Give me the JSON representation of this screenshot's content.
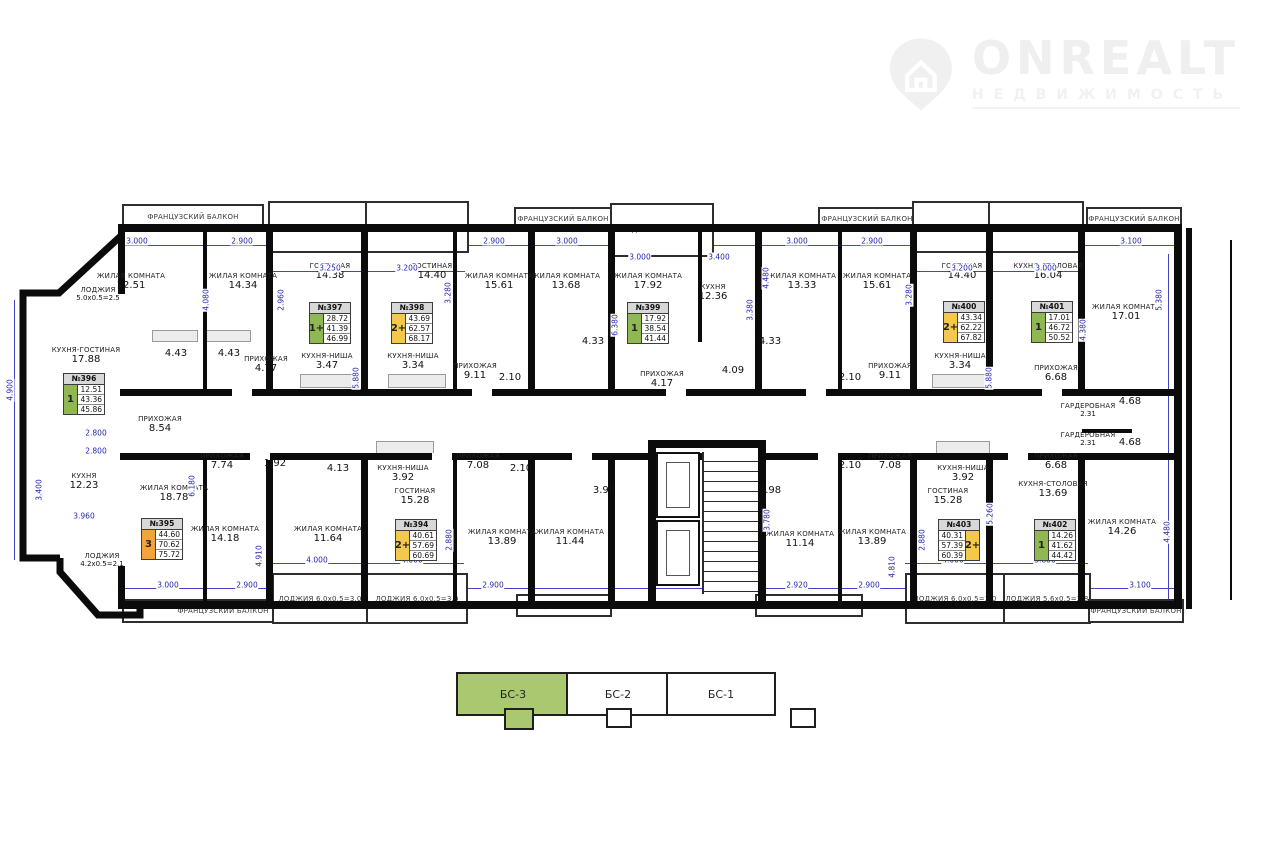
{
  "logo": {
    "brand": "ONREALT",
    "subtitle": "НЕДВИЖИМОСТЬ"
  },
  "colors": {
    "g": "#8fb852",
    "y": "#f3c84b",
    "o": "#f2a33c"
  },
  "apartments": [
    {
      "num": "№396",
      "type": "1",
      "c": "g",
      "vals": [
        "12.51",
        "43.36",
        "45.86"
      ],
      "x": 63,
      "y": 373,
      "m": false
    },
    {
      "num": "№397",
      "type": "1+",
      "c": "g",
      "vals": [
        "28.72",
        "41.39",
        "46.99"
      ],
      "x": 309,
      "y": 302,
      "m": false
    },
    {
      "num": "№398",
      "type": "2+",
      "c": "y",
      "vals": [
        "43.69",
        "62.57",
        "68.17"
      ],
      "x": 391,
      "y": 302,
      "m": false
    },
    {
      "num": "№399",
      "type": "1",
      "c": "g",
      "vals": [
        "17.92",
        "38.54",
        "41.44"
      ],
      "x": 627,
      "y": 302,
      "m": false
    },
    {
      "num": "№400",
      "type": "2+",
      "c": "y",
      "vals": [
        "43.34",
        "62.22",
        "67.82"
      ],
      "x": 943,
      "y": 301,
      "m": false
    },
    {
      "num": "№401",
      "type": "1",
      "c": "g",
      "vals": [
        "17.01",
        "46.72",
        "50.52"
      ],
      "x": 1031,
      "y": 301,
      "m": false
    },
    {
      "num": "№395",
      "type": "3",
      "c": "o",
      "vals": [
        "44.60",
        "70.62",
        "75.72"
      ],
      "x": 141,
      "y": 518,
      "m": false
    },
    {
      "num": "№394",
      "type": "2+",
      "c": "y",
      "vals": [
        "40.61",
        "57.69",
        "60.69"
      ],
      "x": 395,
      "y": 519,
      "m": false
    },
    {
      "num": "№403",
      "type": "2+",
      "c": "y",
      "vals": [
        "40.31",
        "57.39",
        "60.39"
      ],
      "x": 938,
      "y": 519,
      "m": true
    },
    {
      "num": "№402",
      "type": "1",
      "c": "g",
      "vals": [
        "14.26",
        "41.62",
        "44.42"
      ],
      "x": 1034,
      "y": 519,
      "m": false
    }
  ],
  "plan": {
    "walls": [
      [
        120,
        224,
        1062,
        8
      ],
      [
        120,
        601,
        1062,
        8
      ],
      [
        1174,
        224,
        8,
        385
      ],
      [
        118,
        224,
        7,
        70
      ],
      [
        118,
        566,
        7,
        43
      ],
      [
        120,
        389,
        1056,
        7
      ],
      [
        120,
        453,
        1056,
        7
      ],
      [
        203,
        232,
        4,
        158
      ],
      [
        266,
        232,
        7,
        158
      ],
      [
        361,
        232,
        7,
        158
      ],
      [
        453,
        232,
        4,
        158
      ],
      [
        528,
        232,
        7,
        158
      ],
      [
        608,
        232,
        7,
        158
      ],
      [
        698,
        232,
        4,
        110
      ],
      [
        755,
        232,
        7,
        158
      ],
      [
        838,
        232,
        4,
        158
      ],
      [
        910,
        232,
        7,
        158
      ],
      [
        986,
        232,
        7,
        158
      ],
      [
        1078,
        232,
        7,
        158
      ],
      [
        203,
        460,
        4,
        142
      ],
      [
        266,
        460,
        7,
        142
      ],
      [
        361,
        460,
        7,
        142
      ],
      [
        453,
        460,
        4,
        142
      ],
      [
        528,
        460,
        7,
        142
      ],
      [
        608,
        460,
        7,
        142
      ],
      [
        838,
        460,
        4,
        142
      ],
      [
        910,
        460,
        7,
        142
      ],
      [
        986,
        460,
        7,
        142
      ],
      [
        1078,
        460,
        7,
        142
      ],
      [
        648,
        440,
        8,
        162
      ],
      [
        758,
        440,
        8,
        162
      ],
      [
        648,
        440,
        118,
        8
      ],
      [
        1082,
        429,
        50,
        4
      ],
      [
        1186,
        228,
        6,
        381
      ],
      [
        1230,
        240,
        2,
        360
      ]
    ],
    "door_gaps": [
      [
        232,
        389,
        20,
        7
      ],
      [
        472,
        389,
        20,
        7
      ],
      [
        666,
        389,
        20,
        7
      ],
      [
        806,
        389,
        20,
        7
      ],
      [
        1042,
        389,
        20,
        7
      ],
      [
        250,
        453,
        20,
        7
      ],
      [
        432,
        453,
        20,
        7
      ],
      [
        572,
        453,
        20,
        7
      ],
      [
        818,
        453,
        20,
        7
      ],
      [
        1008,
        453,
        20,
        7
      ]
    ],
    "dim_lines": [
      [
        125,
        245,
        1053,
        1
      ],
      [
        125,
        588,
        1053,
        1
      ],
      [
        14,
        300,
        1,
        260
      ],
      [
        1168,
        254,
        1,
        348
      ],
      [
        270,
        271,
        195,
        1
      ],
      [
        912,
        271,
        168,
        1
      ],
      [
        272,
        563,
        192,
        1
      ],
      [
        905,
        563,
        183,
        1
      ]
    ],
    "fixtures": [
      [
        300,
        374,
        56,
        12
      ],
      [
        388,
        374,
        56,
        12
      ],
      [
        932,
        374,
        52,
        12
      ],
      [
        376,
        441,
        56,
        11
      ],
      [
        936,
        441,
        52,
        11
      ],
      [
        152,
        330,
        44,
        10
      ],
      [
        205,
        330,
        44,
        10
      ]
    ],
    "balcony_boxes": [
      {
        "x": 122,
        "y": 204,
        "w": 138,
        "h": 21,
        "label": "ФРАНЦУЗСКИЙ БАЛКОН"
      },
      {
        "x": 268,
        "y": 201,
        "w": 97,
        "h": 48,
        "label": "ЛОДЖИЯ 11.2x0.5=5.6"
      },
      {
        "x": 365,
        "y": 201,
        "w": 100,
        "h": 48,
        "label": "ЛОДЖИЯ 11.2x0.5=5.6"
      },
      {
        "x": 514,
        "y": 207,
        "w": 94,
        "h": 19,
        "label": "ФРАНЦУЗСКИЙ БАЛКОН"
      },
      {
        "x": 610,
        "y": 203,
        "w": 100,
        "h": 50,
        "label": "ЛОДЖИЯ 5.8x0.5=2.9"
      },
      {
        "x": 818,
        "y": 207,
        "w": 94,
        "h": 19,
        "label": "ФРАНЦУЗСКИЙ БАЛКОН"
      },
      {
        "x": 912,
        "y": 201,
        "w": 76,
        "h": 48,
        "label": "ЛОДЖИЯ 11.2x0.5=5.6"
      },
      {
        "x": 988,
        "y": 201,
        "w": 92,
        "h": 48,
        "label": "ЛОДЖИЯ 7.6x0.5=3.8"
      },
      {
        "x": 1086,
        "y": 207,
        "w": 92,
        "h": 19,
        "label": "ФРАНЦУЗСКИЙ БАЛКОН"
      },
      {
        "x": 122,
        "y": 599,
        "w": 198,
        "h": 20,
        "label": "ФРАНЦУЗСКИЙ БАЛКОН"
      },
      {
        "x": 272,
        "y": 573,
        "w": 92,
        "h": 47,
        "label": "ЛОДЖИЯ 6.0x0.5=3.0"
      },
      {
        "x": 366,
        "y": 573,
        "w": 98,
        "h": 47,
        "label": "ЛОДЖИЯ 6.0x0.5=3.0"
      },
      {
        "x": 516,
        "y": 594,
        "w": 92,
        "h": 19,
        "label": "ФРАНЦУЗСКИЙ БАЛКОН"
      },
      {
        "x": 755,
        "y": 594,
        "w": 104,
        "h": 19,
        "label": "ФРАНЦУЗСКИЙ БАЛКОН"
      },
      {
        "x": 905,
        "y": 573,
        "w": 96,
        "h": 47,
        "label": "ЛОДЖИЯ 6.0x0.5=3.0"
      },
      {
        "x": 1003,
        "y": 573,
        "w": 84,
        "h": 47,
        "label": "ЛОДЖИЯ 5.6x0.5=2.8"
      },
      {
        "x": 1088,
        "y": 599,
        "w": 92,
        "h": 20,
        "label": "ФРАНЦУЗСКИЙ БАЛКОН"
      }
    ],
    "rooms": [
      {
        "n": "ЖИЛАЯ КОМНАТА",
        "a": "12.51",
        "x": 131,
        "y": 272
      },
      {
        "n": "ЖИЛАЯ КОМНАТА",
        "a": "14.34",
        "x": 243,
        "y": 272
      },
      {
        "n": "ГОСТИНАЯ",
        "a": "14.38",
        "x": 330,
        "y": 262
      },
      {
        "n": "ГОСТИНАЯ",
        "a": "14.40",
        "x": 432,
        "y": 262
      },
      {
        "n": "ЖИЛАЯ КОМНАТА",
        "a": "15.61",
        "x": 499,
        "y": 272
      },
      {
        "n": "ЖИЛАЯ КОМНАТА",
        "a": "13.68",
        "x": 566,
        "y": 272
      },
      {
        "n": "ЖИЛАЯ КОМНАТА",
        "a": "17.92",
        "x": 648,
        "y": 272
      },
      {
        "n": "КУХНЯ",
        "a": "12.36",
        "x": 713,
        "y": 283
      },
      {
        "n": "ЖИЛАЯ КОМНАТА",
        "a": "13.33",
        "x": 802,
        "y": 272
      },
      {
        "n": "ЖИЛАЯ КОМНАТА",
        "a": "15.61",
        "x": 877,
        "y": 272
      },
      {
        "n": "ГОСТИНАЯ",
        "a": "14.40",
        "x": 962,
        "y": 262
      },
      {
        "n": "КУХНЯ-СТОЛОВАЯ",
        "a": "16.04",
        "x": 1048,
        "y": 262
      },
      {
        "n": "ЖИЛАЯ КОМНАТА",
        "a": "17.01",
        "x": 1126,
        "y": 303
      },
      {
        "n": "ЛОДЖИЯ",
        "a": "5.0x0.5=2.5",
        "x": 98,
        "y": 286,
        "s": true
      },
      {
        "n": "КУХНЯ-ГОСТИНАЯ",
        "a": "17.88",
        "x": 86,
        "y": 346
      },
      {
        "n": "",
        "a": "4.43",
        "x": 176,
        "y": 348
      },
      {
        "n": "",
        "a": "4.43",
        "x": 229,
        "y": 348
      },
      {
        "n": "ПРИХОЖАЯ",
        "a": "4.77",
        "x": 266,
        "y": 355
      },
      {
        "n": "КУХНЯ-НИША",
        "a": "3.47",
        "x": 327,
        "y": 352
      },
      {
        "n": "КУХНЯ-НИША",
        "a": "3.34",
        "x": 413,
        "y": 352
      },
      {
        "n": "ПРИХОЖАЯ",
        "a": "9.11",
        "x": 475,
        "y": 362
      },
      {
        "n": "",
        "a": "2.10",
        "x": 510,
        "y": 372
      },
      {
        "n": "",
        "a": "4.33",
        "x": 593,
        "y": 336
      },
      {
        "n": "ПРИХОЖАЯ",
        "a": "4.17",
        "x": 662,
        "y": 370
      },
      {
        "n": "",
        "a": "4.09",
        "x": 733,
        "y": 365
      },
      {
        "n": "",
        "a": "4.33",
        "x": 770,
        "y": 336
      },
      {
        "n": "",
        "a": "2.10",
        "x": 850,
        "y": 372
      },
      {
        "n": "ПРИХОЖАЯ",
        "a": "9.11",
        "x": 890,
        "y": 362
      },
      {
        "n": "КУХНЯ-НИША",
        "a": "3.34",
        "x": 960,
        "y": 352
      },
      {
        "n": "ПРИХОЖАЯ",
        "a": "6.68",
        "x": 1056,
        "y": 364
      },
      {
        "n": "ГАРДЕРОБНАЯ",
        "a": "2.31",
        "x": 1088,
        "y": 402,
        "s": true
      },
      {
        "n": "",
        "a": "4.68",
        "x": 1130,
        "y": 396
      },
      {
        "n": "ГАРДЕРОБНАЯ",
        "a": "2.31",
        "x": 1088,
        "y": 431,
        "s": true
      },
      {
        "n": "",
        "a": "4.68",
        "x": 1130,
        "y": 437
      },
      {
        "n": "ПРИХОЖАЯ",
        "a": "6.68",
        "x": 1056,
        "y": 452
      },
      {
        "n": "ПРИХОЖАЯ",
        "a": "8.54",
        "x": 160,
        "y": 415
      },
      {
        "n": "ПРИХОЖАЯ",
        "a": "7.74",
        "x": 222,
        "y": 452
      },
      {
        "n": "",
        "a": "1.92",
        "x": 275,
        "y": 458
      },
      {
        "n": "",
        "a": "4.13",
        "x": 338,
        "y": 463
      },
      {
        "n": "КУХНЯ-НИША",
        "a": "3.92",
        "x": 403,
        "y": 464
      },
      {
        "n": "ПРИХОЖАЯ",
        "a": "7.08",
        "x": 478,
        "y": 452
      },
      {
        "n": "",
        "a": "2.10",
        "x": 521,
        "y": 463
      },
      {
        "n": "",
        "a": "2.10",
        "x": 850,
        "y": 460
      },
      {
        "n": "ПРИХОЖАЯ",
        "a": "7.08",
        "x": 890,
        "y": 452
      },
      {
        "n": "КУХНЯ-НИША",
        "a": "3.92",
        "x": 963,
        "y": 464
      },
      {
        "n": "",
        "a": "3.98",
        "x": 604,
        "y": 485
      },
      {
        "n": "",
        "a": "3.98",
        "x": 770,
        "y": 485
      },
      {
        "n": "КУХНЯ",
        "a": "12.23",
        "x": 84,
        "y": 472
      },
      {
        "n": "ЖИЛАЯ КОМНАТА",
        "a": "18.78",
        "x": 174,
        "y": 484
      },
      {
        "n": "ГОСТИНАЯ",
        "a": "15.28",
        "x": 415,
        "y": 487
      },
      {
        "n": "ГОСТИНАЯ",
        "a": "15.28",
        "x": 948,
        "y": 487
      },
      {
        "n": "КУХНЯ-СТОЛОВАЯ",
        "a": "13.69",
        "x": 1053,
        "y": 480
      },
      {
        "n": "ЖИЛАЯ КОМНАТА",
        "a": "14.26",
        "x": 1122,
        "y": 518
      },
      {
        "n": "ЖИЛАЯ КОМНАТА",
        "a": "14.18",
        "x": 225,
        "y": 525
      },
      {
        "n": "ЖИЛАЯ КОМНАТА",
        "a": "11.64",
        "x": 328,
        "y": 525
      },
      {
        "n": "ЖИЛАЯ КОМНАТА",
        "a": "13.89",
        "x": 502,
        "y": 528
      },
      {
        "n": "ЖИЛАЯ КОМНАТА",
        "a": "11.44",
        "x": 570,
        "y": 528
      },
      {
        "n": "ЖИЛАЯ КОМНАТА",
        "a": "11.14",
        "x": 800,
        "y": 530
      },
      {
        "n": "ЖИЛАЯ КОМНАТА",
        "a": "13.89",
        "x": 872,
        "y": 528
      },
      {
        "n": "ЛОДЖИЯ",
        "a": "4.2x0.5=2.1",
        "x": 102,
        "y": 552,
        "s": true
      }
    ],
    "dims": [
      {
        "t": "3.000",
        "x": 137,
        "y": 241
      },
      {
        "t": "2.900",
        "x": 242,
        "y": 241
      },
      {
        "t": "2.900",
        "x": 494,
        "y": 241
      },
      {
        "t": "3.000",
        "x": 567,
        "y": 241
      },
      {
        "t": "3.000",
        "x": 797,
        "y": 241
      },
      {
        "t": "2.900",
        "x": 872,
        "y": 241
      },
      {
        "t": "3.100",
        "x": 1131,
        "y": 241
      },
      {
        "t": "3.250",
        "x": 330,
        "y": 268
      },
      {
        "t": "3.200",
        "x": 407,
        "y": 268
      },
      {
        "t": "3.000",
        "x": 640,
        "y": 257
      },
      {
        "t": "3.400",
        "x": 719,
        "y": 257
      },
      {
        "t": "3.200",
        "x": 962,
        "y": 268
      },
      {
        "t": "3.000",
        "x": 1046,
        "y": 268
      },
      {
        "t": "3.000",
        "x": 168,
        "y": 585
      },
      {
        "t": "2.900",
        "x": 247,
        "y": 585
      },
      {
        "t": "2.900",
        "x": 493,
        "y": 585
      },
      {
        "t": "2.920",
        "x": 797,
        "y": 585
      },
      {
        "t": "2.900",
        "x": 869,
        "y": 585
      },
      {
        "t": "3.100",
        "x": 1140,
        "y": 585
      },
      {
        "t": "4.000",
        "x": 317,
        "y": 560
      },
      {
        "t": "4.000",
        "x": 412,
        "y": 560
      },
      {
        "t": "4.000",
        "x": 953,
        "y": 560
      },
      {
        "t": "3.800",
        "x": 1045,
        "y": 560
      },
      {
        "t": "2.800",
        "x": 96,
        "y": 433
      },
      {
        "t": "2.800",
        "x": 96,
        "y": 451
      },
      {
        "t": "3.960",
        "x": 84,
        "y": 516
      },
      {
        "t": "4.900",
        "x": 10,
        "y": 390,
        "v": true
      },
      {
        "t": "3.400",
        "x": 39,
        "y": 490,
        "v": true
      },
      {
        "t": "4.080",
        "x": 206,
        "y": 300,
        "v": true
      },
      {
        "t": "2.960",
        "x": 281,
        "y": 300,
        "v": true
      },
      {
        "t": "3.280",
        "x": 448,
        "y": 293,
        "v": true
      },
      {
        "t": "6.380",
        "x": 615,
        "y": 325,
        "v": true
      },
      {
        "t": "3.380",
        "x": 750,
        "y": 310,
        "v": true
      },
      {
        "t": "4.480",
        "x": 766,
        "y": 278,
        "v": true
      },
      {
        "t": "3.280",
        "x": 909,
        "y": 295,
        "v": true
      },
      {
        "t": "4.380",
        "x": 1083,
        "y": 330,
        "v": true
      },
      {
        "t": "5.380",
        "x": 1159,
        "y": 300,
        "v": true
      },
      {
        "t": "5.880",
        "x": 356,
        "y": 378,
        "v": true
      },
      {
        "t": "5.880",
        "x": 989,
        "y": 378,
        "v": true
      },
      {
        "t": "6.180",
        "x": 192,
        "y": 486,
        "v": true
      },
      {
        "t": "4.910",
        "x": 259,
        "y": 556,
        "v": true
      },
      {
        "t": "4.810",
        "x": 892,
        "y": 567,
        "v": true
      },
      {
        "t": "2.880",
        "x": 449,
        "y": 540,
        "v": true
      },
      {
        "t": "2.880",
        "x": 922,
        "y": 540,
        "v": true
      },
      {
        "t": "5.260",
        "x": 990,
        "y": 514,
        "v": true
      },
      {
        "t": "3.780",
        "x": 767,
        "y": 520,
        "v": true
      },
      {
        "t": "4.480",
        "x": 1167,
        "y": 532,
        "v": true
      }
    ],
    "elevators": [
      [
        656,
        452,
        40,
        62
      ],
      [
        656,
        520,
        40,
        62
      ]
    ],
    "stairs": [
      702,
      452,
      54,
      142
    ]
  },
  "legend": {
    "sections": [
      {
        "label": "БС-3",
        "active": true,
        "x": 456,
        "y": 672,
        "w": 110,
        "h": 40
      },
      {
        "label": "БС-2",
        "active": false,
        "x": 566,
        "y": 672,
        "w": 100,
        "h": 40
      },
      {
        "label": "БС-1",
        "active": false,
        "x": 666,
        "y": 672,
        "w": 106,
        "h": 40
      }
    ],
    "bumps": [
      {
        "x": 504,
        "y": 708,
        "w": 26,
        "h": 18,
        "active": true
      },
      {
        "x": 606,
        "y": 708,
        "w": 22,
        "h": 16,
        "active": false
      },
      {
        "x": 790,
        "y": 708,
        "w": 22,
        "h": 16,
        "active": false
      }
    ]
  }
}
